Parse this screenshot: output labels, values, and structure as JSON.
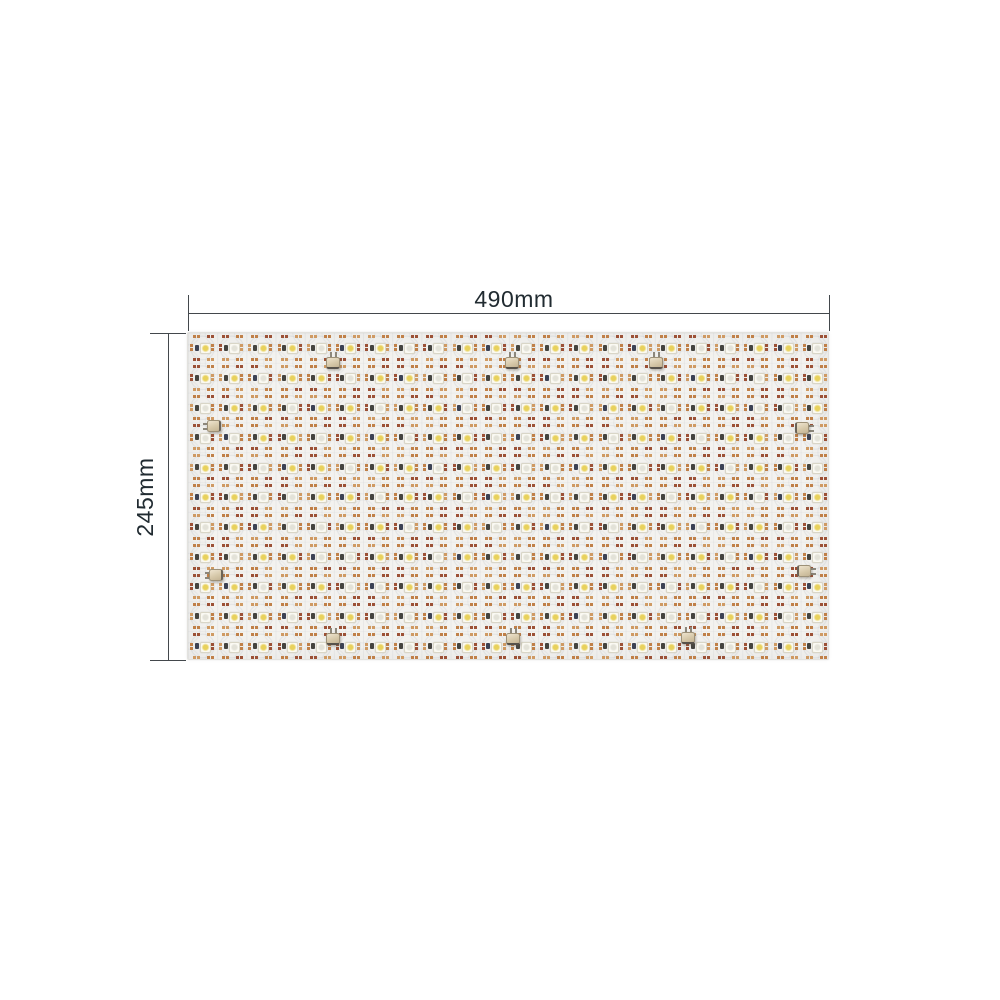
{
  "photo": {
    "background_color": "#ffffff",
    "subject": "flexible LED sheet panel"
  },
  "dimensions": {
    "width_label": "490mm",
    "height_label": "245mm",
    "line_color": "#43484c",
    "text_color": "#212b31"
  },
  "panel": {
    "grid": {
      "rows": 11,
      "cols": 22
    },
    "colors": {
      "board": "#f3f2ef",
      "etch_ring": "#b2b8c0",
      "pad_orange": "#c08048",
      "pad_rust": "#9c5136",
      "pad_tan": "#cf9a63",
      "chip_dark": "#45443f",
      "chip_blue": "#3c4254",
      "led_warm": "#e8d15c",
      "led_cool": "#e3e2d8",
      "connector_body": "#d7c9aa",
      "connector_pin": "#cbc6ba"
    },
    "connectors": [
      {
        "x": 332,
        "y": 362,
        "dir": "up"
      },
      {
        "x": 511,
        "y": 362,
        "dir": "up"
      },
      {
        "x": 655,
        "y": 362,
        "dir": "up"
      },
      {
        "x": 213,
        "y": 425,
        "dir": "left"
      },
      {
        "x": 801,
        "y": 427,
        "dir": "right"
      },
      {
        "x": 215,
        "y": 574,
        "dir": "left"
      },
      {
        "x": 803,
        "y": 570,
        "dir": "right"
      },
      {
        "x": 332,
        "y": 638,
        "dir": "up"
      },
      {
        "x": 512,
        "y": 638,
        "dir": "up"
      },
      {
        "x": 687,
        "y": 637,
        "dir": "up"
      }
    ],
    "panel_rect": {
      "left": 187,
      "top": 332,
      "width": 642,
      "height": 328
    }
  }
}
